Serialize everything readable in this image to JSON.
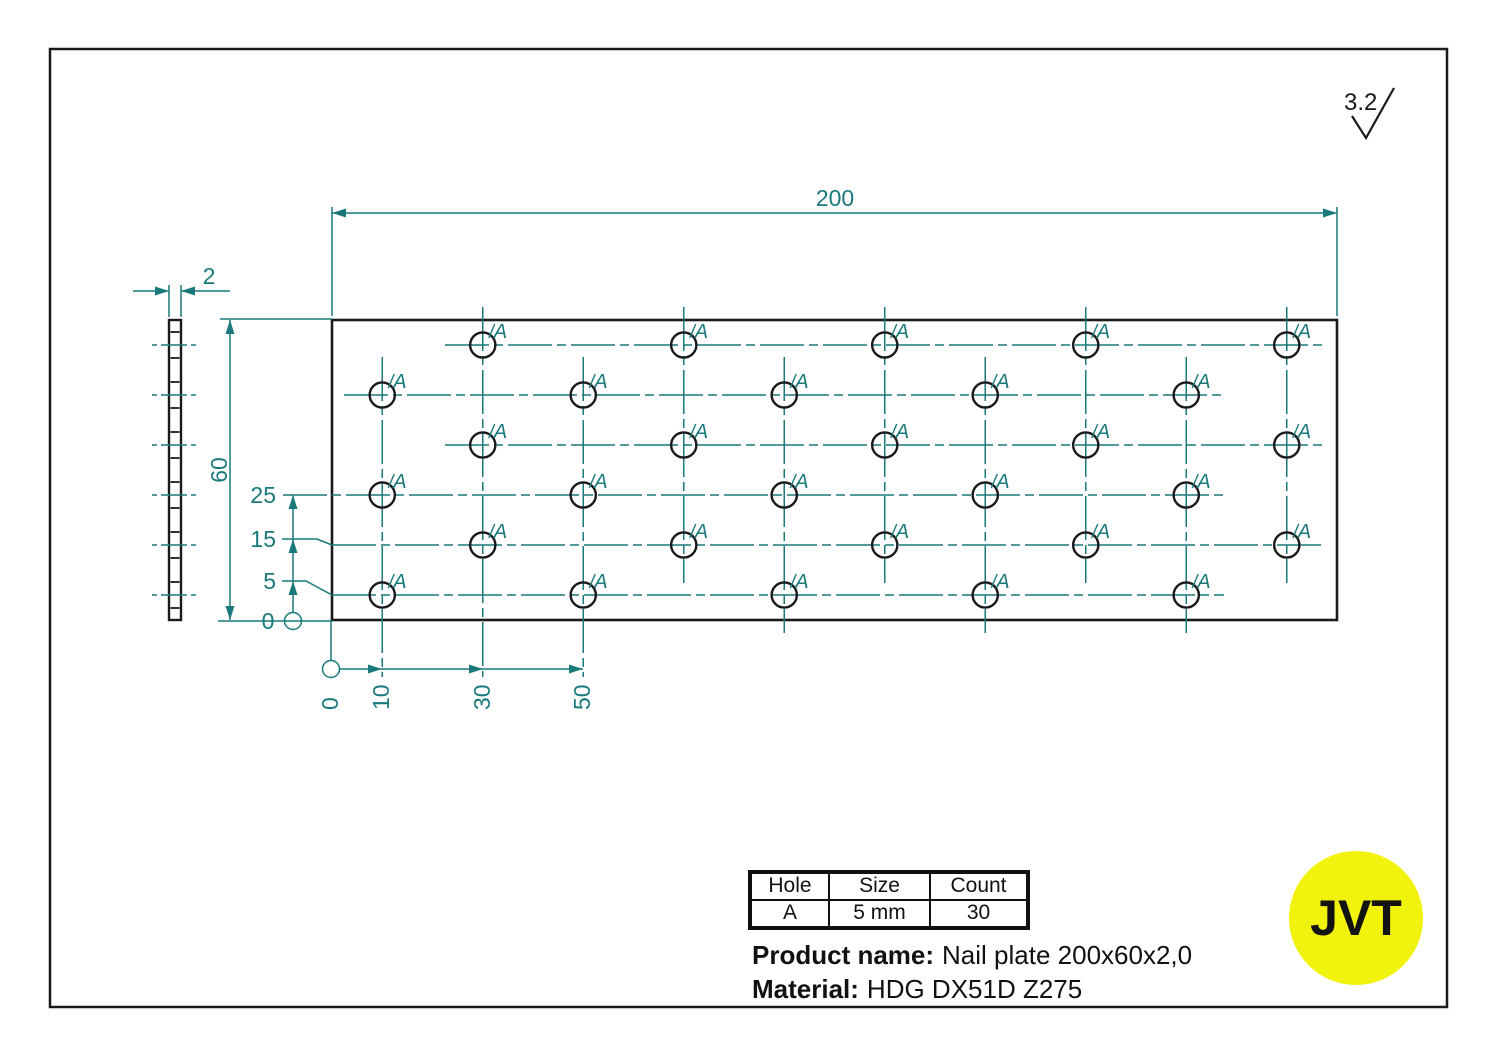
{
  "drawing": {
    "color_teal": "#1a797b",
    "color_black": "#1a1a1a",
    "dim_width": "200",
    "dim_height": "60",
    "dim_thickness": "2",
    "ordinates_left": [
      "25",
      "15",
      "5",
      "0"
    ],
    "ordinates_bottom": [
      "0",
      "10",
      "30",
      "50"
    ],
    "hole_label": "A",
    "roughness": "3.2",
    "pattern": {
      "origin_px": {
        "x": 332,
        "y": 620
      },
      "px_per_mm_x": 5.025,
      "px_per_mm_y": 5.0,
      "rows_mm": [
        5,
        15,
        25,
        35,
        45,
        55
      ],
      "cols_rows_5_25_45_mm": [
        10,
        50,
        90,
        130,
        170
      ],
      "cols_rows_15_35_55_mm": [
        30,
        70,
        110,
        150,
        190
      ],
      "hole_diameter_mm": 5,
      "hole_count": 30
    }
  },
  "table": {
    "headers": [
      "Hole",
      "Size",
      "Count"
    ],
    "rows": [
      [
        "A",
        "5 mm",
        "30"
      ]
    ]
  },
  "product": {
    "label": "Product name:",
    "value": "Nail plate 200x60x2,0"
  },
  "material": {
    "label": "Material:",
    "value": "HDG DX51D Z275"
  },
  "logo": {
    "text": "JVT",
    "bg": "#f2f30d"
  }
}
